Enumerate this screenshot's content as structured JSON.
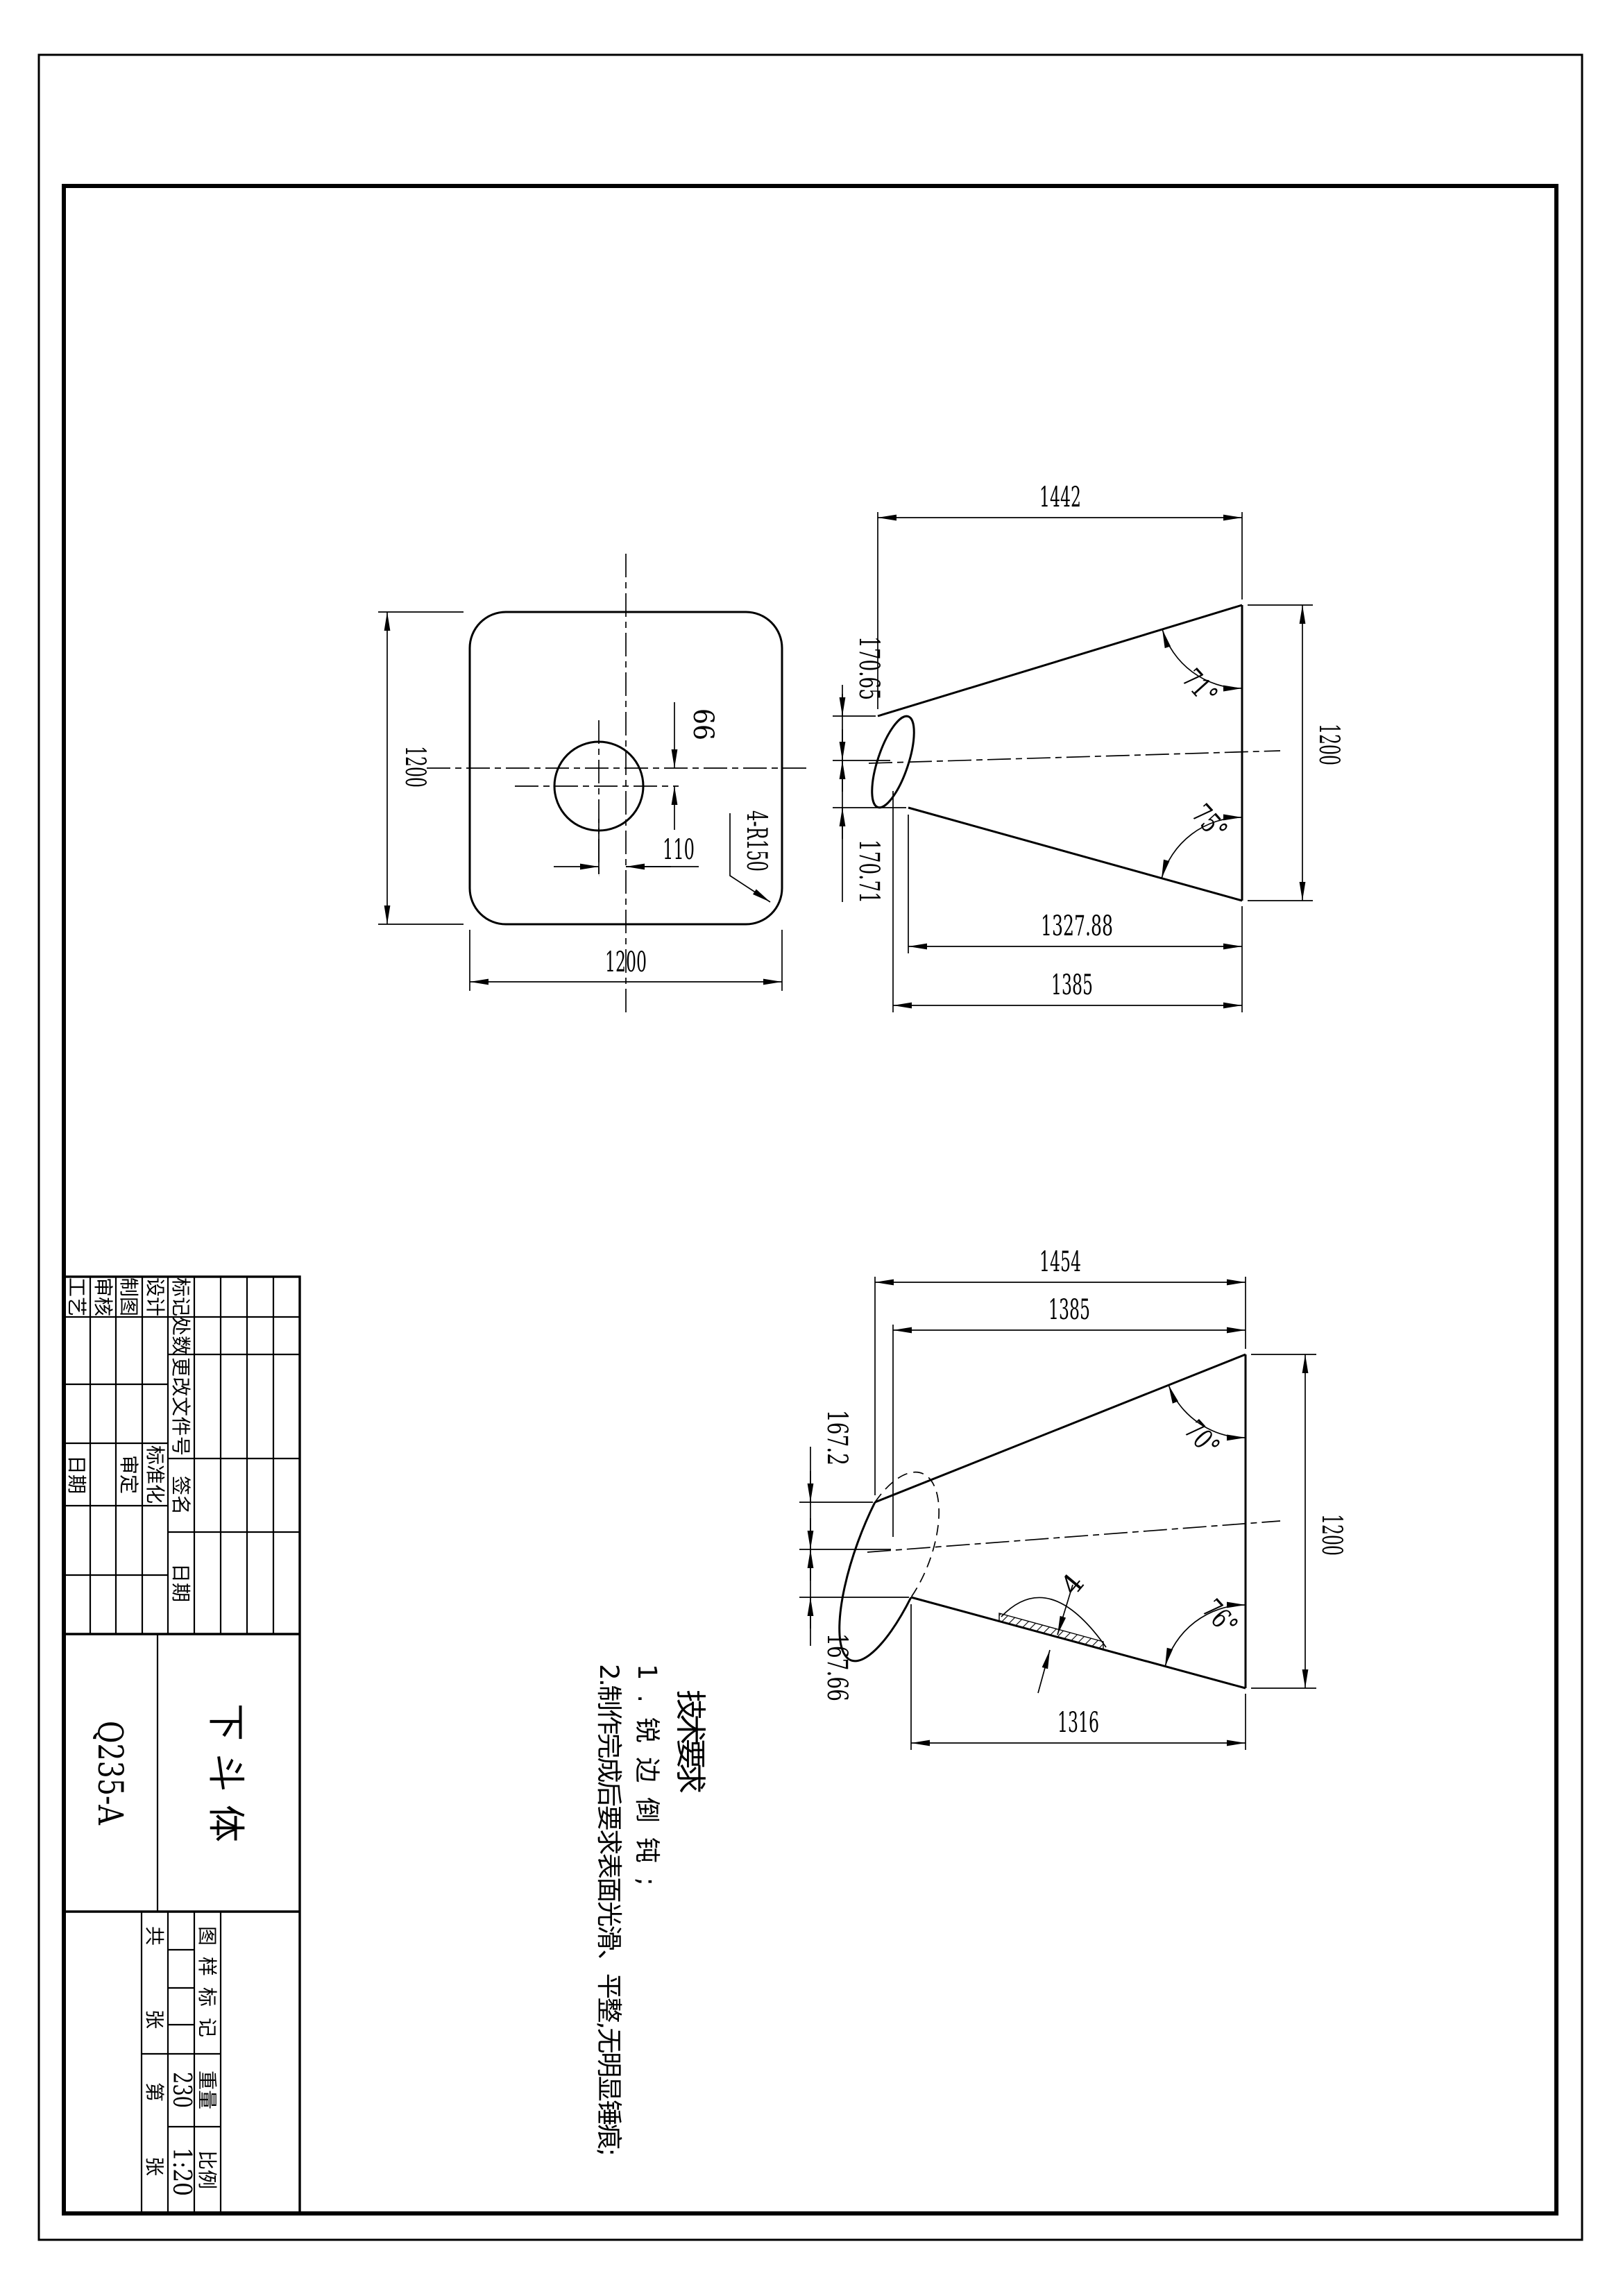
{
  "accent_color": "#000000",
  "paper_color": "#ffffff",
  "views": {
    "flange": {
      "size_vertical": "1200",
      "size_horizontal": "1200",
      "hole_offset_x": "110",
      "hole_offset_y": "66",
      "corner_radius": "4-R150"
    },
    "cone_top": {
      "overall_length": "1442",
      "big_end_diameter": "1200",
      "small_half_top": "170.65",
      "small_half_bottom": "170.71",
      "inner_length": "1327.88",
      "mid_length": "1385",
      "angle_upper": "71°",
      "angle_lower": "75°"
    },
    "cone_bottom": {
      "overall_length": "1454",
      "mid_length": "1385",
      "big_end_diameter": "1200",
      "small_half_top": "167.2",
      "small_half_bottom": "167.66",
      "inner_length": "1316",
      "angle_upper": "70°",
      "angle_lower": "76°",
      "wall_thickness": "4"
    }
  },
  "tech_req": {
    "title": "技术要求",
    "item1": "1.锐边倒钝;",
    "item2": "2.制作完成后要求表面光滑、平整,无明显锤痕;"
  },
  "title_block": {
    "rev_mark": "标记",
    "rev_count": "处数",
    "rev_doc_no": "更改文件号",
    "rev_sign": "签名",
    "rev_date": "日期",
    "design": "设计",
    "standardization": "标准化",
    "draft": "制图",
    "approve": "审定",
    "check": "审核",
    "process": "工艺",
    "process_date": "日期",
    "part_name": "下斗体",
    "material": "Q235-A",
    "stamp_label": "图样标记",
    "weight_label": "重量",
    "weight_value": "230",
    "scale_label": "比例",
    "scale_value": "1:20",
    "sheet_total_label": "共",
    "sheet_total_unit": "张",
    "sheet_no_label": "第",
    "sheet_no_unit": "张"
  }
}
